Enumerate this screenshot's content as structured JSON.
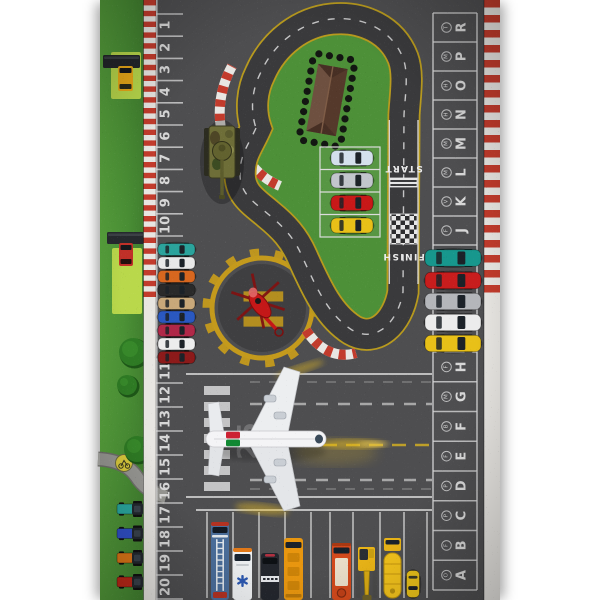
{
  "photo": {
    "background": "#ffffff"
  },
  "colors": {
    "asphalt": "#4e4e50",
    "track": "#3a3a3c",
    "infield_grass": "#4d9038",
    "side_grass": "#4c9238",
    "mowed_patch": "#b9d84b",
    "curb_red": "#c23b2c",
    "curb_white": "#e8e6e2",
    "marking_white": "#e4e4e4",
    "edge_yellow": "#b89a1e",
    "helipad_gold": "#c49a1c",
    "helicopter_red": "#c41818"
  },
  "left_parking": {
    "numbers": [
      "1",
      "2",
      "3",
      "4",
      "5",
      "6",
      "7",
      "8",
      "9",
      "10",
      "11",
      "12",
      "13",
      "14",
      "15",
      "16",
      "17",
      "18",
      "19",
      "20"
    ],
    "cars": [
      {
        "color": "teal",
        "hex": "#2ba39c"
      },
      {
        "color": "white",
        "hex": "#e8e8e8"
      },
      {
        "color": "orange",
        "hex": "#d8671f"
      },
      {
        "color": "black",
        "hex": "#2a2a2a"
      },
      {
        "color": "beige",
        "hex": "#c8a87a"
      },
      {
        "color": "blue",
        "hex": "#2a58c0"
      },
      {
        "color": "crimson",
        "hex": "#b02848"
      },
      {
        "color": "white",
        "hex": "#ededed"
      },
      {
        "color": "dark-red",
        "hex": "#8c1a1a"
      }
    ]
  },
  "right_parking": {
    "spaces": [
      {
        "letter": "R",
        "logo": "toyota-logo"
      },
      {
        "letter": "P",
        "logo": "mercedes-logo"
      },
      {
        "letter": "O",
        "logo": "hyundai-logo"
      },
      {
        "letter": "N",
        "logo": "honda-logo"
      },
      {
        "letter": "M",
        "logo": "mitsubishi-logo"
      },
      {
        "letter": "L",
        "logo": "mazda-logo"
      },
      {
        "letter": "K",
        "logo": "volkswagen-logo"
      },
      {
        "letter": "J",
        "logo": "ford-logo"
      },
      {
        "letter": "H",
        "logo": "ford-logo"
      },
      {
        "letter": "G",
        "logo": "mercedes-logo"
      },
      {
        "letter": "F",
        "logo": "bmw-logo"
      },
      {
        "letter": "E",
        "logo": "fiat-logo"
      },
      {
        "letter": "D",
        "logo": "porsche-logo"
      },
      {
        "letter": "C",
        "logo": "peugeot-logo"
      },
      {
        "letter": "B",
        "logo": "ferrari-logo"
      },
      {
        "letter": "A",
        "logo": "opel-logo"
      }
    ],
    "cars": [
      {
        "color": "teal",
        "hex": "#17978d"
      },
      {
        "color": "red",
        "hex": "#c81d1d"
      },
      {
        "color": "silver",
        "hex": "#b4b6ba"
      },
      {
        "color": "white",
        "hex": "#ececec"
      },
      {
        "color": "yellow",
        "hex": "#e8c018"
      }
    ]
  },
  "race_track": {
    "start_label": "START",
    "finish_label": "FINISH",
    "pit_cars": [
      {
        "color": "blue-white",
        "hex": "#d4e0ec"
      },
      {
        "color": "silver",
        "hex": "#c2c6cc"
      },
      {
        "color": "red",
        "hex": "#c81818"
      },
      {
        "color": "yellow",
        "hex": "#e8c018"
      }
    ]
  },
  "runway": {
    "number_marking": "25"
  },
  "helipad": {
    "marking": "H"
  },
  "bottom_parking": {
    "vehicles": [
      "fire-ladder-truck",
      "ambulance",
      "police-van",
      "school-bus",
      "fire-truck",
      "excavator",
      "tanker-truck",
      "taxi-car"
    ]
  },
  "grass_area": {
    "trucks": [
      "yellow-semi-truck",
      "red-semi-truck"
    ],
    "tractors": [
      {
        "color": "teal",
        "hex": "#2aa89f"
      },
      {
        "color": "blue",
        "hex": "#3050c8"
      },
      {
        "color": "orange",
        "hex": "#e07818"
      },
      {
        "color": "red",
        "hex": "#c02818"
      }
    ],
    "sign": "bicycle-sign"
  }
}
